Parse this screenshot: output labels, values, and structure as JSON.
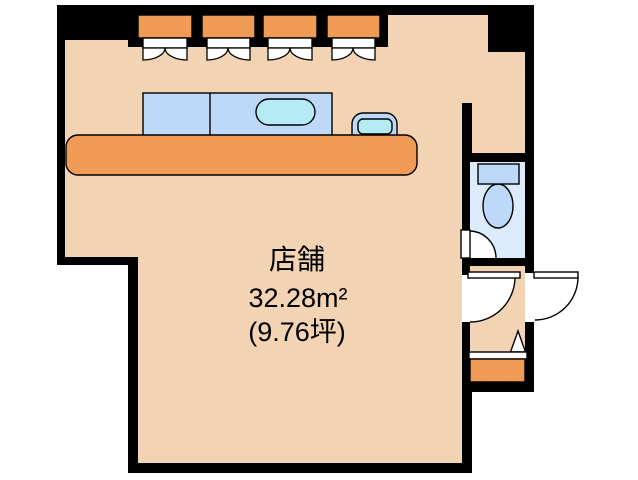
{
  "plan": {
    "room_label": "店舗",
    "area_sqm": "32.28m²",
    "area_tsubo": "(9.76坪)"
  },
  "colors": {
    "wall": "#000000",
    "floor": "#f2d4b4",
    "orange": "#f09b55",
    "fixture_blue": "#bdd9f7",
    "water_cyan": "#b5ebf5",
    "toilet_floor": "#dcebfb",
    "background": "#ffffff",
    "line": "#000000"
  },
  "fixtures": {
    "window_count": 4,
    "items": [
      "double-casement-window",
      "kitchen-counter",
      "kitchen-sink",
      "hand-basin",
      "service-counter",
      "toilet",
      "toilet-door",
      "room-door",
      "entry-door",
      "genkan-step"
    ]
  }
}
